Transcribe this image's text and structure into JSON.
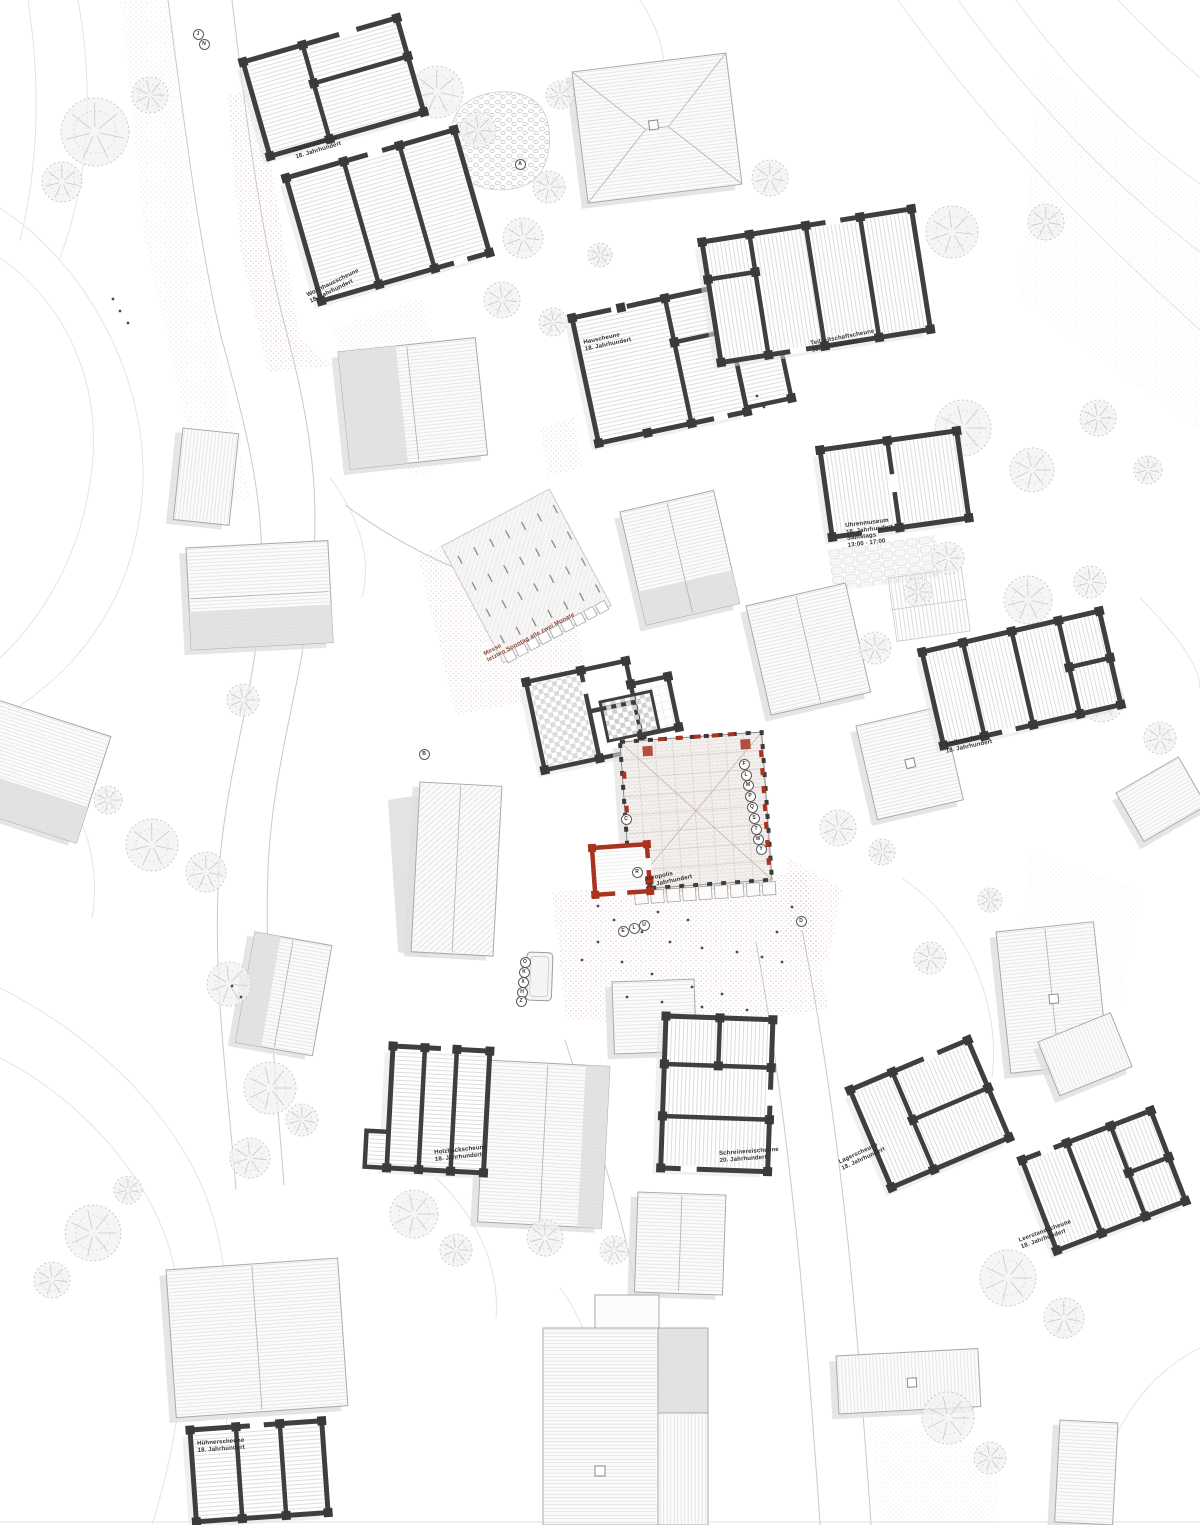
{
  "palette": {
    "accent_red": "#a8331f",
    "label_red": "#8f4335",
    "wall_dark": "#3f3f3f",
    "paper": "#ffffff"
  },
  "labels": [
    {
      "id": "gartenscheune",
      "lines": [
        "Gartenscheune",
        "18. Jahrhundert"
      ],
      "x": 293,
      "y": 148,
      "rot": -17,
      "color": "dark"
    },
    {
      "id": "wohnhausscheune",
      "lines": [
        "Wohnhausscheune",
        "18. Jahrhundert"
      ],
      "x": 306,
      "y": 293,
      "rot": -26,
      "color": "dark"
    },
    {
      "id": "hauscheune",
      "lines": [
        "Hauscheune",
        "18. Jahrhundert"
      ],
      "x": 583,
      "y": 340,
      "rot": -12,
      "color": "dark"
    },
    {
      "id": "teilzeitschaftscheune",
      "lines": [
        "Teilzeitschaftscheune",
        "18. Jahrhundert"
      ],
      "x": 810,
      "y": 341,
      "rot": -11,
      "color": "dark"
    },
    {
      "id": "uhrenmuseum",
      "lines": [
        "Uhrenmuseum",
        "18. Jahrhundert",
        "Samstags",
        "13:00 - 17:00"
      ],
      "x": 845,
      "y": 523,
      "rot": -7,
      "color": "dark"
    },
    {
      "id": "messe",
      "lines": [
        "Messe",
        "letzten Sonntag alle zwei Monate"
      ],
      "x": 483,
      "y": 652,
      "rot": -28,
      "color": "red"
    },
    {
      "id": "atelierscheune",
      "lines": [
        "Atelierscheune",
        "18. Jahrhundert"
      ],
      "x": 944,
      "y": 742,
      "rot": -12,
      "color": "dark"
    },
    {
      "id": "akropolis",
      "lines": [
        "Akropolis",
        "20. Jahrhundert"
      ],
      "x": 644,
      "y": 877,
      "rot": -12,
      "color": "dark"
    },
    {
      "id": "holzhackscheune",
      "lines": [
        "Holzhackscheune",
        "18. Jahrhundert"
      ],
      "x": 434,
      "y": 1150,
      "rot": -6,
      "color": "dark"
    },
    {
      "id": "schreinereischeune",
      "lines": [
        "Schreinereischeune",
        "20. Jahrhundert"
      ],
      "x": 719,
      "y": 1151,
      "rot": -4,
      "color": "dark"
    },
    {
      "id": "lagerscheune",
      "lines": [
        "Lagerscheune",
        "18. Jahrhundert"
      ],
      "x": 838,
      "y": 1160,
      "rot": -25,
      "color": "dark"
    },
    {
      "id": "leerstandscheune",
      "lines": [
        "Leerstandscheune",
        "18. Jahrhundert"
      ],
      "x": 1018,
      "y": 1238,
      "rot": -20,
      "color": "dark"
    },
    {
      "id": "huehnerscheune",
      "lines": [
        "Hühnerscheune",
        "18. Jahrhundert"
      ],
      "x": 197,
      "y": 1441,
      "rot": -4,
      "color": "dark"
    }
  ],
  "markers": [
    {
      "letter": "J",
      "x": 197,
      "y": 33
    },
    {
      "letter": "N",
      "x": 203,
      "y": 43
    },
    {
      "letter": "A",
      "x": 519,
      "y": 163
    },
    {
      "letter": "B",
      "x": 423,
      "y": 753
    },
    {
      "letter": "C",
      "x": 625,
      "y": 818
    },
    {
      "letter": "F",
      "x": 743,
      "y": 763
    },
    {
      "letter": "L",
      "x": 745,
      "y": 774
    },
    {
      "letter": "M",
      "x": 747,
      "y": 784
    },
    {
      "letter": "P",
      "x": 749,
      "y": 795
    },
    {
      "letter": "Q",
      "x": 751,
      "y": 806
    },
    {
      "letter": "S",
      "x": 753,
      "y": 817
    },
    {
      "letter": "T",
      "x": 755,
      "y": 828
    },
    {
      "letter": "W",
      "x": 757,
      "y": 838
    },
    {
      "letter": "Y",
      "x": 760,
      "y": 848
    },
    {
      "letter": "R",
      "x": 636,
      "y": 871
    },
    {
      "letter": "E",
      "x": 622,
      "y": 930
    },
    {
      "letter": "L",
      "x": 633,
      "y": 927
    },
    {
      "letter": "U",
      "x": 643,
      "y": 924
    },
    {
      "letter": "D",
      "x": 800,
      "y": 920
    },
    {
      "letter": "O",
      "x": 524,
      "y": 961
    },
    {
      "letter": "K",
      "x": 523,
      "y": 971
    },
    {
      "letter": "X",
      "x": 522,
      "y": 981
    },
    {
      "letter": "H",
      "x": 521,
      "y": 991
    },
    {
      "letter": "Z",
      "x": 520,
      "y": 1000
    }
  ]
}
